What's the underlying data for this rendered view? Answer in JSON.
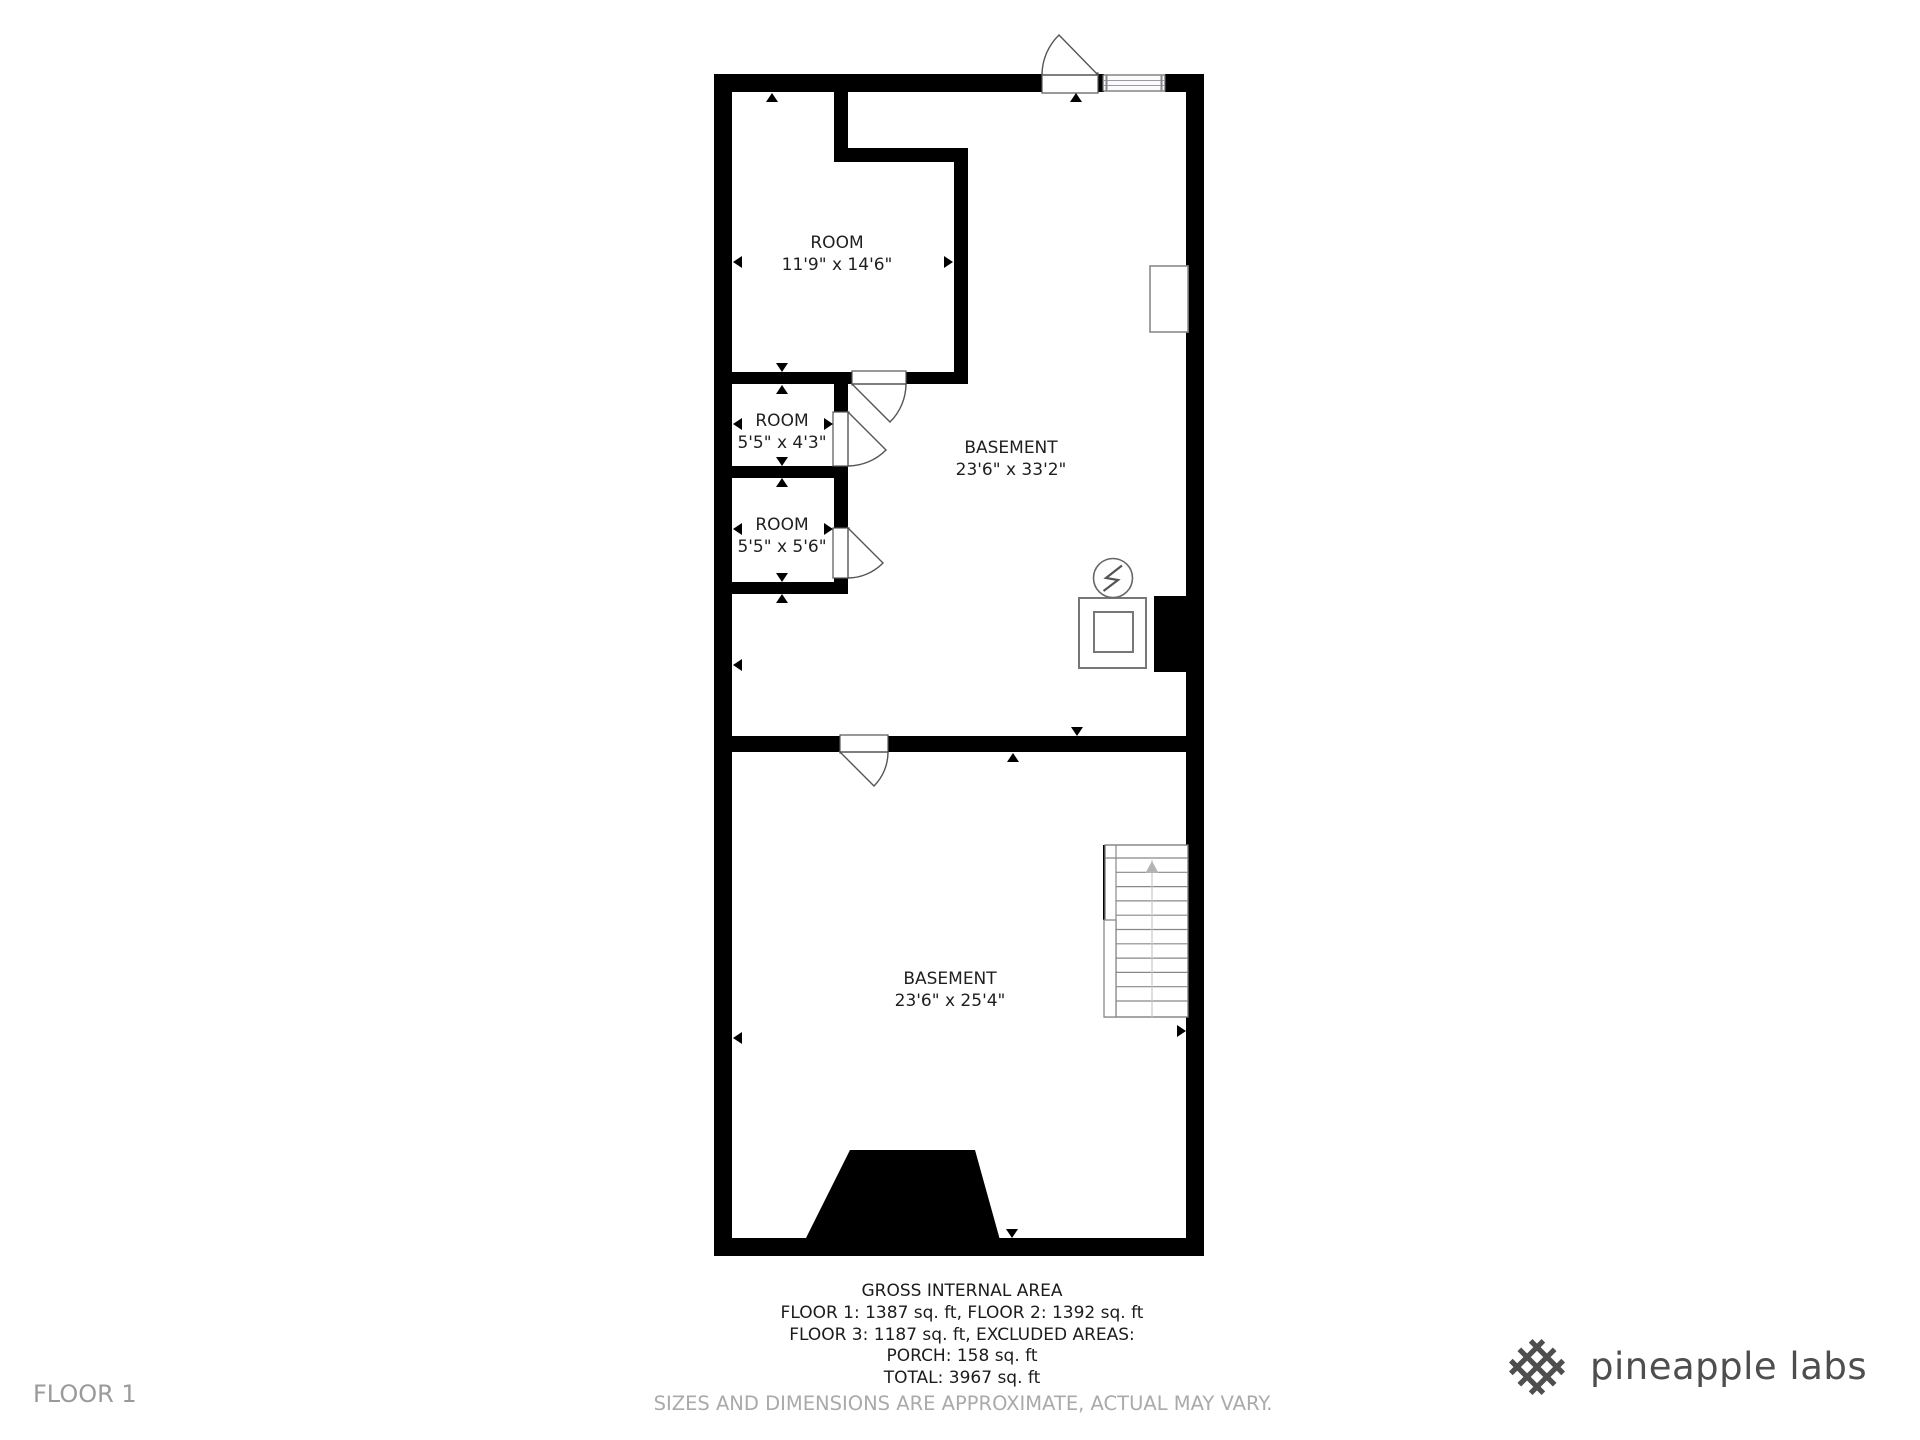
{
  "floor_plan": {
    "rooms": [
      {
        "label": "ROOM",
        "dimensions": "11'9\" x 14'6\""
      },
      {
        "label": "ROOM",
        "dimensions": "5'5\" x 4'3\""
      },
      {
        "label": "ROOM",
        "dimensions": "5'5\" x 5'6\""
      },
      {
        "label": "BASEMENT",
        "dimensions": "23'6\" x 33'2\""
      },
      {
        "label": "BASEMENT",
        "dimensions": "23'6\" x 25'4\""
      }
    ]
  },
  "area_summary": {
    "title": "GROSS INTERNAL AREA",
    "line1": "FLOOR 1: 1387 sq. ft, FLOOR 2: 1392 sq. ft",
    "line2": "FLOOR 3: 1187 sq. ft, EXCLUDED AREAS:",
    "line3": "PORCH: 158 sq. ft",
    "line4": "TOTAL: 3967 sq. ft"
  },
  "footer": {
    "floor_label": "FLOOR 1",
    "disclaimer": "SIZES AND DIMENSIONS ARE APPROXIMATE, ACTUAL MAY VARY.",
    "brand": "pineapple labs"
  },
  "colors": {
    "wall": "#000000",
    "text": "#1f1f1f",
    "muted_text": "#aaaaaa",
    "brand_text": "#4e4e4e"
  },
  "icons": [
    {
      "name": "pineapple-lattice-icon"
    },
    {
      "name": "electrical-bolt-icon"
    },
    {
      "name": "stairs-up-arrow-icon"
    }
  ]
}
